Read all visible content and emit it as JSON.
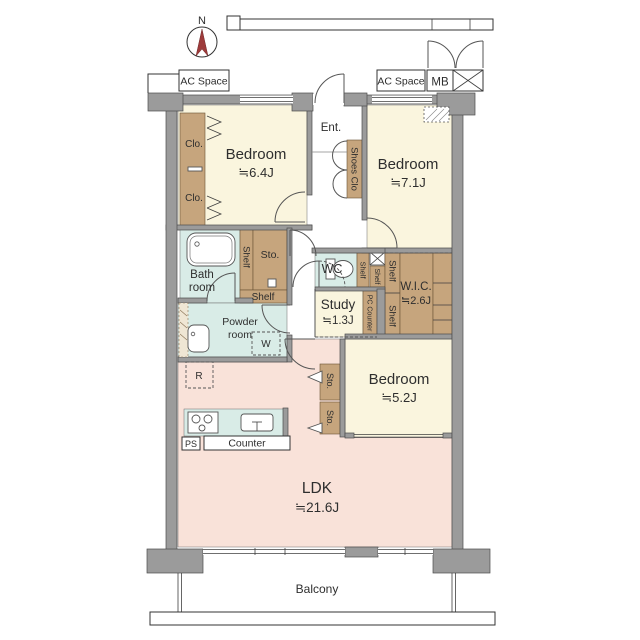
{
  "compass": {
    "north_label": "N"
  },
  "exterior": {
    "ac_space_left": "AC Space",
    "ac_space_right": "AC Space",
    "meter_box": "MB",
    "balcony": "Balcony"
  },
  "rooms": {
    "bedroom_nw": {
      "name": "Bedroom",
      "size": "≒6.4J"
    },
    "bedroom_ne": {
      "name": "Bedroom",
      "size": "≒7.1J"
    },
    "bedroom_se": {
      "name": "Bedroom",
      "size": "≒5.2J"
    },
    "ldk": {
      "name": "LDK",
      "size": "≒21.6J"
    },
    "study": {
      "name": "Study",
      "size": "≒1.3J"
    },
    "wic": {
      "name": "W.I.C.",
      "size": "≒2.6J"
    },
    "bath": {
      "line1": "Bath",
      "line2": "room"
    },
    "powder_room": {
      "line1": "Powder",
      "line2": "room"
    },
    "wc": {
      "name": "WC"
    },
    "entrance": {
      "name": "Ent."
    }
  },
  "storage": {
    "closet_upper": "Clo.",
    "closet_lower": "Clo.",
    "shoes_closet": "Shoes Clo",
    "hall_storage": "Sto.",
    "bath_shelf_side": "Shelf",
    "bath_shelf_bottom": "Shelf",
    "wc_shelf_side": "Shelf",
    "wc_shelf_small": "Shelf",
    "pc_counter": "PC Counter",
    "wic_shelf_upper": "Shelf",
    "wic_shelf_lower": "Shelf",
    "ldk_storage_upper": "Sto.",
    "ldk_storage_lower": "Sto."
  },
  "kitchen": {
    "counter": "Counter",
    "pipe_space": "PS",
    "refrigerator": "R",
    "washer": "W"
  },
  "colors": {
    "room_cream": "#faf5de",
    "ldk_pink": "#f9e2d9",
    "wet_area_cyan": "#d9ece7",
    "storage_tan": "#c6a57d",
    "wall_gray": "#9b9b9b",
    "compass_red": "#9e3b3b"
  }
}
